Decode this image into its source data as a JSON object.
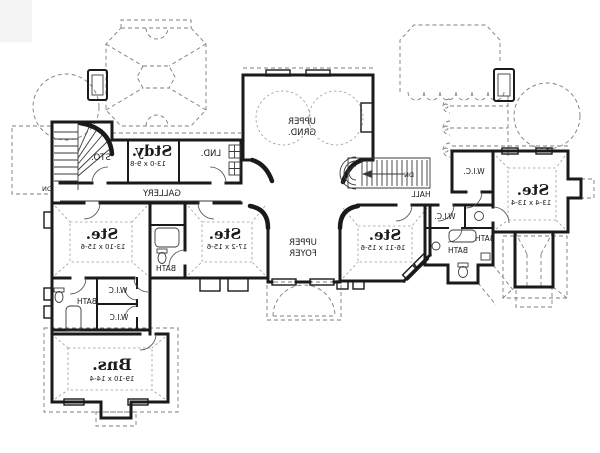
{
  "plan": {
    "rooms": {
      "study": {
        "name": "Stdy.",
        "dims": "13-0 x 9-8"
      },
      "storage": {
        "name": "STO."
      },
      "laundry": {
        "name": "LND."
      },
      "gallery": {
        "name": "GALLERY"
      },
      "upper_grand": {
        "line1": "UPPER",
        "line2": "GRND."
      },
      "upper_foyer": {
        "line1": "UPPER",
        "line2": "FOYER"
      },
      "hall": {
        "name": "HALL"
      },
      "suite_right": {
        "name": "Ste.",
        "dims": "13-4 x 13-4"
      },
      "suite_center_right": {
        "name": "Ste.",
        "dims": "16-11 x 15-6"
      },
      "suite_center_left": {
        "name": "Ste.",
        "dims": "17-2 x 15-6"
      },
      "suite_left": {
        "name": "Ste.",
        "dims": "13-10 x 15-6"
      },
      "bonus": {
        "name": "Bns.",
        "dims": "19-10 x 14-4"
      }
    },
    "closets": {
      "wic_upper_right": "W.I.C.",
      "wic_mid_right": "W.I.C.",
      "wic_left_upper": "W.I.C",
      "wic_left_lower": "W.I.C"
    },
    "baths": {
      "bath_right_upper": "BATH",
      "bath_right_lower": "BATH",
      "bath_center": "BATH",
      "bath_left": "BATH"
    },
    "stairs": {
      "left_down": "DN",
      "center_down": "DN"
    },
    "colors": {
      "wall": "#1a1a1a",
      "dashed": "#7d7d7d",
      "paper": "#ffffff",
      "text": "#1c1c1c"
    }
  }
}
